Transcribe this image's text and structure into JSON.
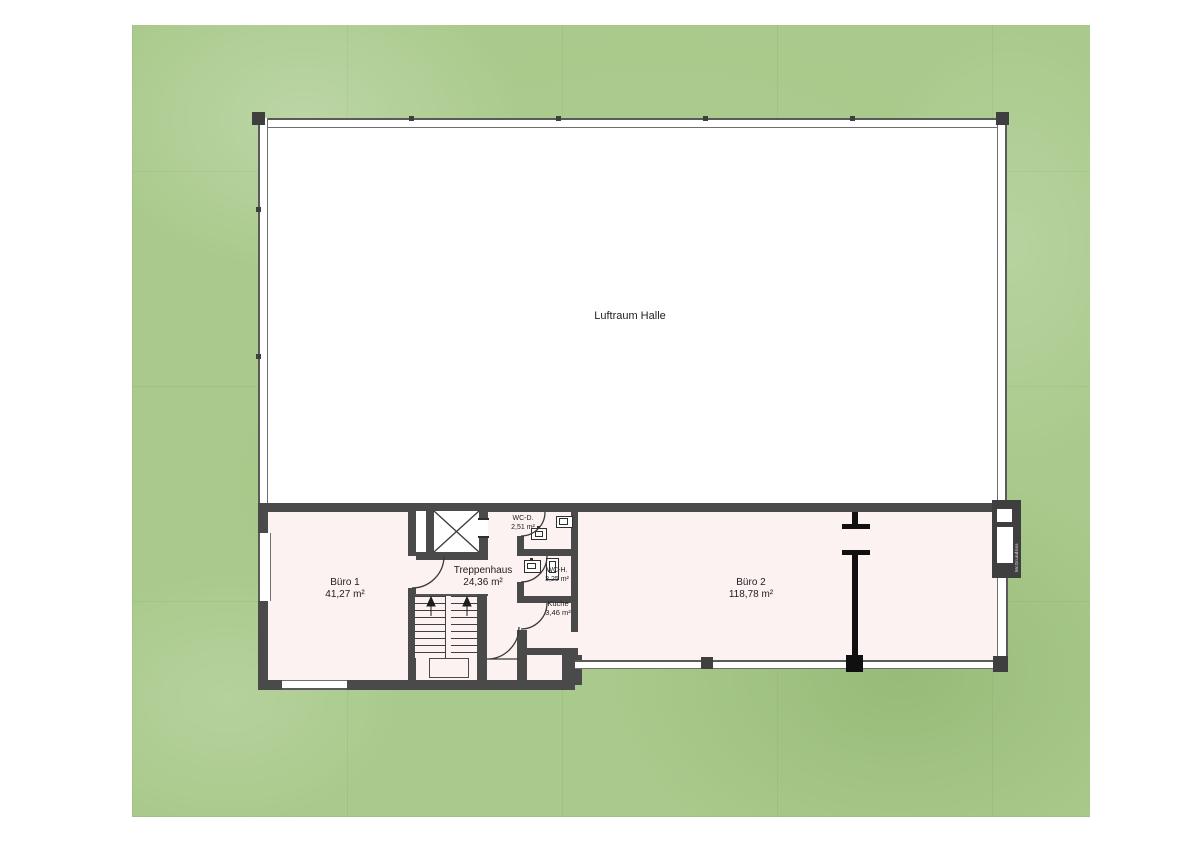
{
  "plan": {
    "hall": {
      "label": "Luftraum Halle"
    },
    "buero1": {
      "label": "Büro 1",
      "area": "41,27 m²"
    },
    "treppenhaus": {
      "label": "Treppenhaus",
      "area": "24,36 m²"
    },
    "wc_d": {
      "label": "WC-D.",
      "area": "2,51 m²"
    },
    "wc_h": {
      "label": "WC-H.",
      "area": "3,25 m²"
    },
    "kueche": {
      "label": "Küche",
      "area": "3,46 m²"
    },
    "buero2": {
      "label": "Büro 2",
      "area": "118,78 m²"
    },
    "watermark": {
      "label": "McGrundriss"
    }
  },
  "colors": {
    "wall": "#4a4a4a",
    "partition": "#101010",
    "room_fill": "#fdf2f2",
    "hall_fill": "#ffffff",
    "site_green": "#a9ca8c",
    "door_line": "#3a3a3a"
  }
}
